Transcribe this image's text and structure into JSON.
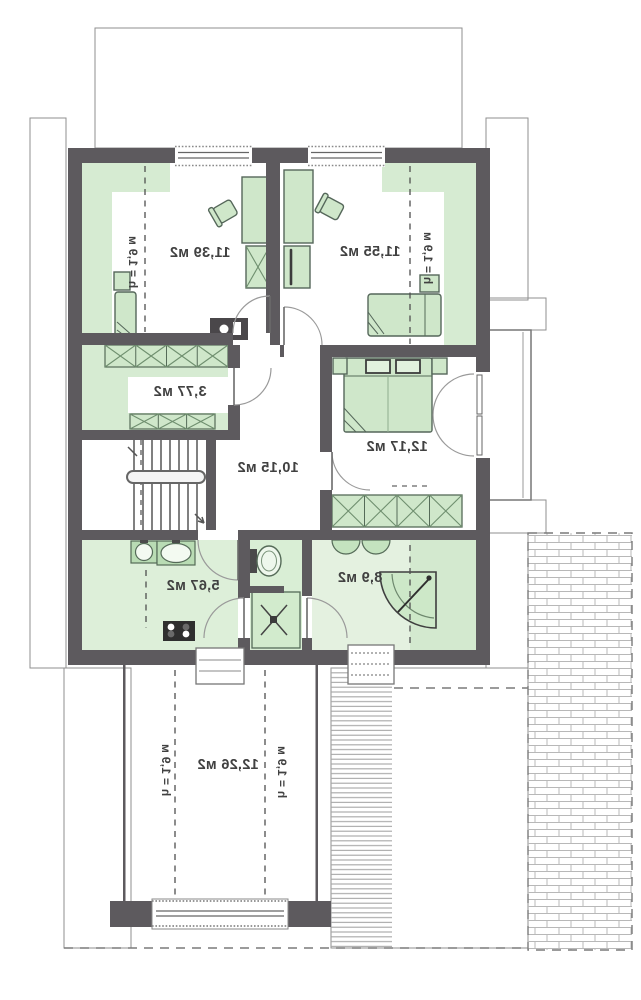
{
  "plan_type": "floor-plan",
  "colors": {
    "wall": "#5d5a5e",
    "room_tint_green": "#d6ebd2",
    "furniture_green": "#cfe7ca",
    "fixture_green": "#b9dcb4",
    "hatch_line": "#a6a6a6",
    "label_text": "#414141",
    "floor_white": "#ffffff"
  },
  "rooms": {
    "top_left": {
      "area": "11,39 м2",
      "height_note": "h = 1,9 м"
    },
    "top_right": {
      "area": "11,55 м2",
      "height_note": "h = 1,9 м"
    },
    "wardrobe": {
      "area": "3,77 м2"
    },
    "hall": {
      "area": "10,15 м2"
    },
    "bedroom": {
      "area": "12,17 м2"
    },
    "utility": {
      "area": "5,67 м2"
    },
    "bathroom": {
      "area": "8,9 м2"
    },
    "attic": {
      "area": "12,26 м2",
      "height_note_left": "h = 1,9 м",
      "height_note_right": "h = 1,9 м"
    }
  }
}
